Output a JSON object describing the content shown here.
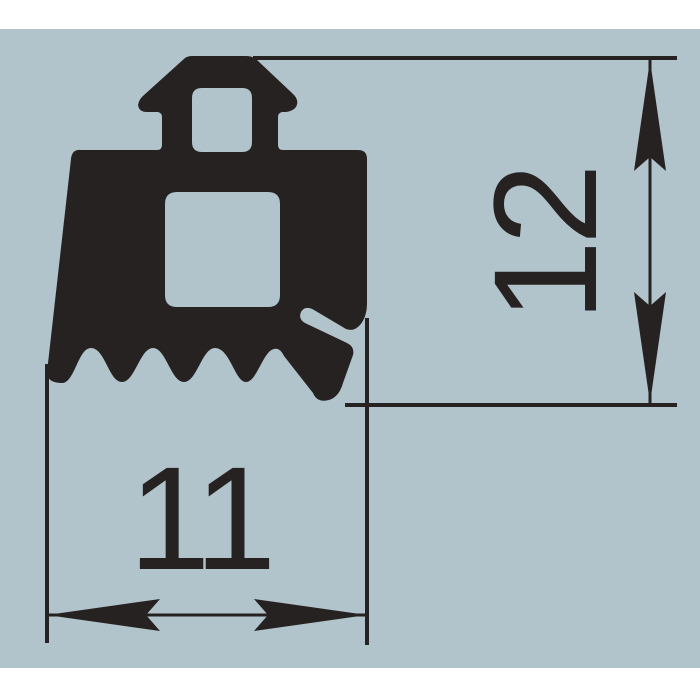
{
  "drawing": {
    "background_color": "#b2c4cb",
    "page_color": "#ffffff",
    "ink_color": "#272222",
    "dimensions": {
      "width": {
        "label": "11"
      },
      "height": {
        "label": "12"
      }
    }
  }
}
